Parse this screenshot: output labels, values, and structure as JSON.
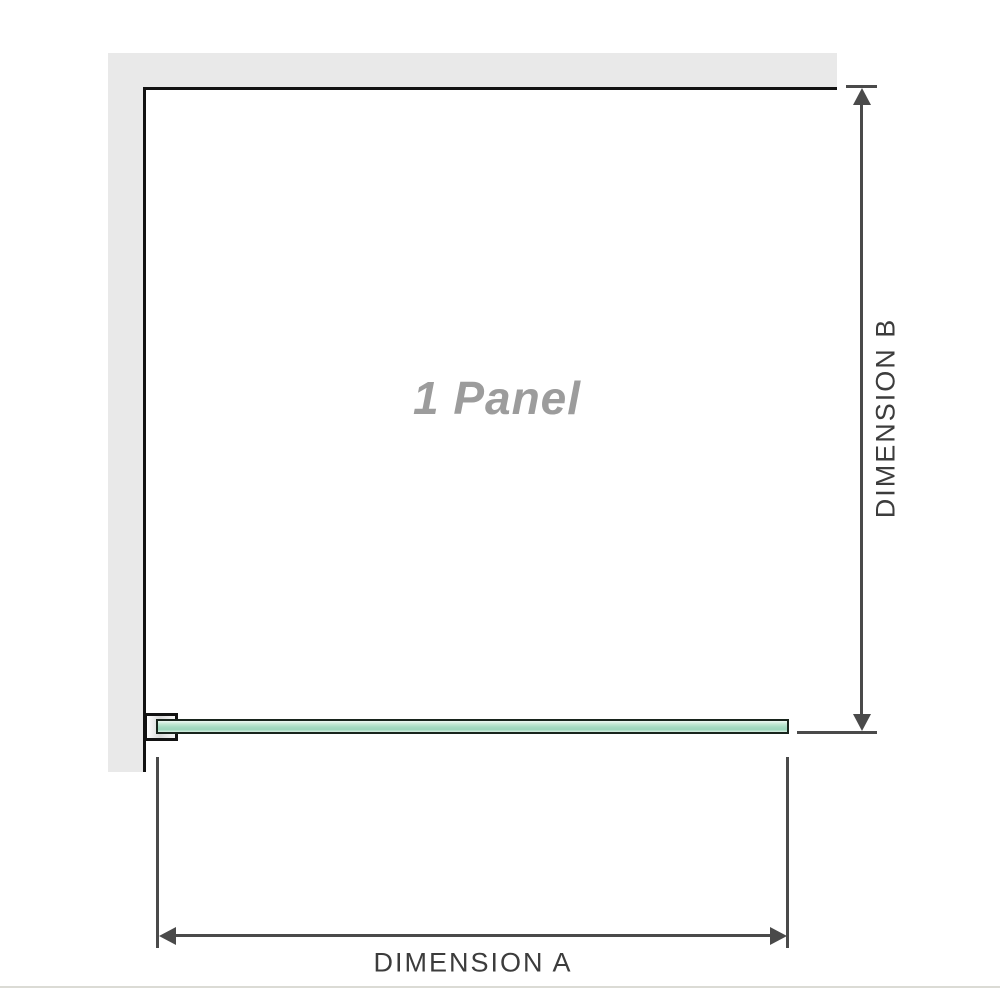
{
  "diagram": {
    "type": "shower-screen-configuration-drawing",
    "panel_label": "1 Panel",
    "dimension_a": {
      "label": "DIMENSION A",
      "orientation": "horizontal",
      "measures": "panel width along glass"
    },
    "dimension_b": {
      "label": "DIMENSION B",
      "orientation": "vertical",
      "measures": "depth from back wall to glass edge"
    },
    "elements": [
      "back-wall",
      "side-wall",
      "wall-bracket",
      "glass-panel"
    ]
  },
  "colors": {
    "wall_fill": "#e9e9e9",
    "wall_edge": "#121212",
    "glass_fill_light": "#eef9f3",
    "glass_fill": "#a6dbc2",
    "glass_border": "#18241c",
    "dimension_line": "#4a4a4a",
    "dimension_text": "#3c3c3c",
    "panel_label_text": "#9c9c9c",
    "separator": "#dbdbd5"
  }
}
